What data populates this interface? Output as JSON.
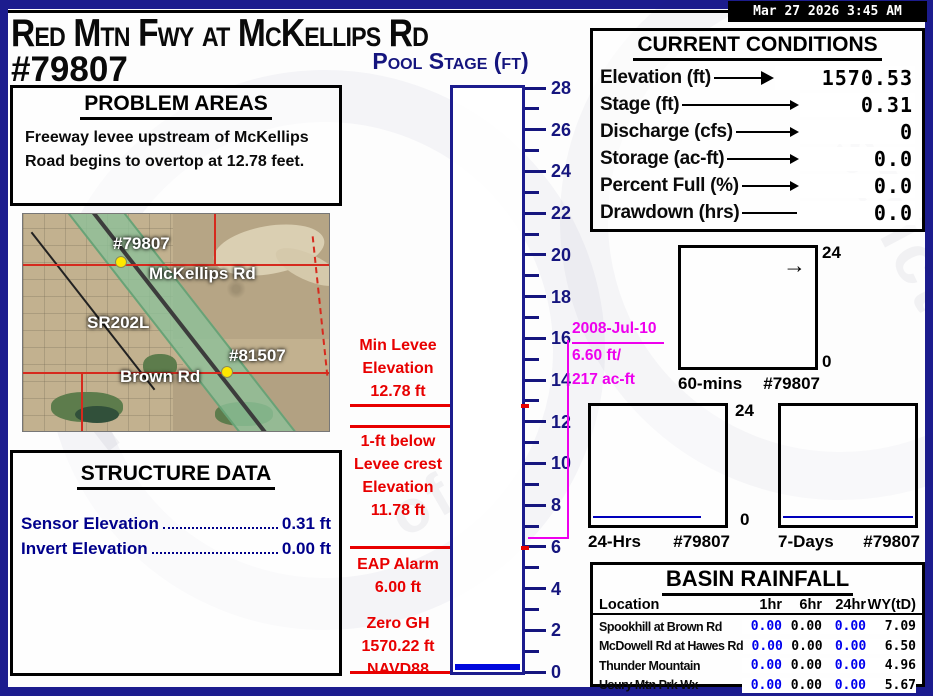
{
  "header": {
    "title": "Red Mtn Fwy at McKellips Rd",
    "station_id": "#79807",
    "timestamp": "Mar 27 2026  3:45 AM",
    "gauge_title": "Pool Stage (ft)"
  },
  "problem_areas": {
    "title": "PROBLEM AREAS",
    "text": "Freeway levee upstream of McKellips Road begins to overtop at 12.78 feet."
  },
  "map": {
    "labels": {
      "primary_station": "#79807",
      "road1": "McKellips Rd",
      "freeway": "SR202L",
      "secondary_station": "#81507",
      "road2": "Brown Rd"
    }
  },
  "structure_data": {
    "title": "STRUCTURE DATA",
    "rows": [
      {
        "label": "Sensor Elevation",
        "value": "0.31 ft"
      },
      {
        "label": "Invert Elevation",
        "value": "0.00 ft"
      }
    ]
  },
  "gauge": {
    "min": 0,
    "max": 28,
    "tick_step": 1,
    "label_step": 2,
    "water_level_ft": 0.31,
    "thresholds": [
      {
        "name": "min-levee-elevation",
        "level_ft": 12.78
      },
      {
        "name": "one-ft-below-levee-crest",
        "level_ft": 11.78
      },
      {
        "name": "eap-alarm",
        "level_ft": 6.0
      },
      {
        "name": "zero-gh",
        "level_ft": 0.0
      }
    ]
  },
  "gauge_notes": {
    "min_levee": [
      "Min Levee",
      "Elevation",
      "12.78 ft"
    ],
    "levee_crest": [
      "1-ft below",
      "Levee crest",
      "Elevation",
      "11.78 ft"
    ],
    "eap": [
      "EAP  Alarm",
      "6.00 ft"
    ],
    "zero": [
      "Zero GH",
      "1570.22 ft",
      "NAVD88"
    ]
  },
  "historic_event": {
    "date": "2008-Jul-10",
    "stage": "6.60 ft/",
    "volume": "217 ac-ft",
    "level_ft": 6.6
  },
  "current_conditions": {
    "title": "CURRENT CONDITIONS",
    "rows": [
      {
        "label": "Elevation (ft)",
        "value": "1570.53",
        "arrow": "big",
        "wide": true
      },
      {
        "label": "Stage (ft)",
        "value": "0.31",
        "arrow": "thin"
      },
      {
        "label": "Discharge (cfs)",
        "value": "0",
        "arrow": "thin"
      },
      {
        "label": "Storage (ac-ft)",
        "value": "0.0",
        "arrow": "thin"
      },
      {
        "label": "Percent Full (%)",
        "value": "0.0",
        "arrow": "thin"
      },
      {
        "label": "Drawdown (hrs)",
        "value": "0.0",
        "arrow": "none"
      }
    ]
  },
  "charts": [
    {
      "name": "60-mins",
      "station": "#79807",
      "ymax": "24",
      "ymin": "0",
      "arrow_glyph": "→"
    },
    {
      "name": "24-Hrs",
      "station": "#79807",
      "ymax": "24",
      "ymin": "0",
      "flatline_ft": 0.31
    },
    {
      "name": "7-Days",
      "station": "#79807",
      "flatline_ft": 0.31
    }
  ],
  "basin_rainfall": {
    "title": "BASIN RAINFALL",
    "headers": [
      "Location",
      "1hr",
      "6hr",
      "24hr",
      "WY(tD)"
    ],
    "rows": [
      [
        "Spookhill at Brown Rd",
        "0.00",
        "0.00",
        "0.00",
        "7.09"
      ],
      [
        "McDowell Rd at Hawes Rd",
        "0.00",
        "0.00",
        "0.00",
        "6.50"
      ],
      [
        "Thunder Mountain",
        "0.00",
        "0.00",
        "0.00",
        "4.96"
      ],
      [
        "Usury Mtn Prk Wx",
        "0.00",
        "0.00",
        "0.00",
        "5.67"
      ]
    ]
  },
  "colors": {
    "frame_navy": "#1c1c8e",
    "tick_navy": "#15157e",
    "alert_red": "#e80000",
    "historic_magenta": "#ee00ee",
    "water_blue": "#0008dd",
    "rain_blue": "#0000ee"
  }
}
